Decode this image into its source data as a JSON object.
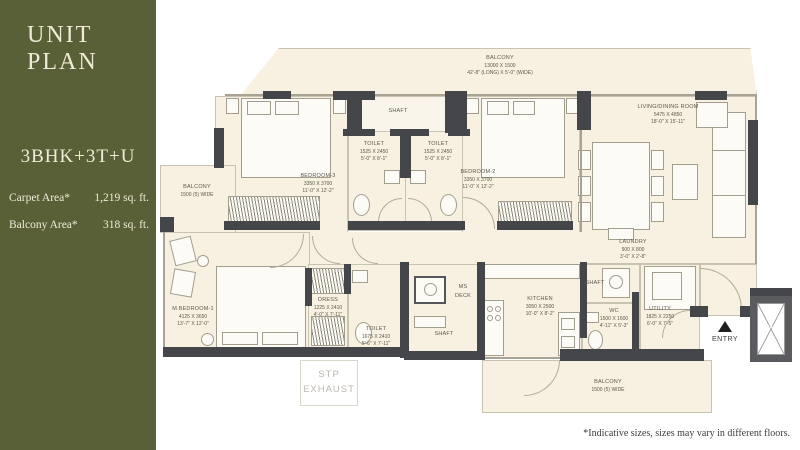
{
  "sidebar": {
    "title": "UNIT PLAN",
    "unit_type": "3BHK+3T+U",
    "stats": [
      {
        "label": "Carpet Area*",
        "value": "1,219 sq. ft."
      },
      {
        "label": "Balcony Area*",
        "value": "318 sq. ft."
      }
    ],
    "bg_color": "#596038",
    "text_color": "#f0ebd7"
  },
  "plan": {
    "rooms": {
      "balcony_top": {
        "name": "BALCONY",
        "mm": "13000 X 1500",
        "ft": "42'-8\" (LONG) X 5'-0\" (WIDE)"
      },
      "shaft_top": {
        "name": "SHAFT"
      },
      "toilet_1": {
        "name": "TOILET",
        "mm": "1525 X 2450",
        "ft": "5'-0\" X 8'-1\""
      },
      "toilet_2": {
        "name": "TOILET",
        "mm": "1525 X 2450",
        "ft": "5'-0\" X 8'-1\""
      },
      "bedroom_3": {
        "name": "BEDROOM-3",
        "mm": "3350 X 3700",
        "ft": "11'-0\" X 12'-2\""
      },
      "bedroom_2": {
        "name": "BEDROOM-2",
        "mm": "3350 X 3700",
        "ft": "11'-0\" X 12'-2\""
      },
      "living": {
        "name": "LIVING/DINING ROOM",
        "mm": "5475 X 4850",
        "ft": "18'-0\" X 15'-11\""
      },
      "balcony_left": {
        "name": "BALCONY",
        "ft": "1500 (5) WIDE"
      },
      "m_bedroom": {
        "name": "M.BEDROOM-1",
        "mm": "4125 X 3650",
        "ft": "13'-7\" X 12'-0\""
      },
      "dress": {
        "name": "DRESS",
        "mm": "1225 X 2410",
        "ft": "4'-0\" X 7'-11\""
      },
      "toilet_m": {
        "name": "TOILET",
        "mm": "1675 X 2410",
        "ft": "5'-6\" X 7'-11\""
      },
      "ms_deck": {
        "line1": "MS",
        "line2": "DECK"
      },
      "shaft_mid": {
        "name": "SHAFT"
      },
      "kitchen": {
        "name": "KITCHEN",
        "mm": "3050 X 2500",
        "ft": "10'-0\" X 8'-2\""
      },
      "laundry": {
        "name": "LAUNDRY",
        "mm": "900 X 800",
        "ft": "3'-0\" X 2'-8\""
      },
      "shaft_laundry": {
        "name": "SHAFT"
      },
      "wc": {
        "name": "WC",
        "mm": "1500 X 1600",
        "ft": "4'-11\" X 5'-3\""
      },
      "utility": {
        "name": "UTILITY",
        "mm": "1825 X 2250",
        "ft": "6'-0\" X 7'-5\""
      },
      "balcony_bottom": {
        "name": "BALCONY",
        "ft": "1500 (5) WIDE"
      },
      "stp": {
        "line1": "STP",
        "line2": "EXHAUST"
      },
      "entry": {
        "name": "ENTRY"
      },
      "shaft_right": {
        "name": "SHAFT"
      }
    },
    "colors": {
      "floor": "#f8f0e0",
      "wall": "#45464a",
      "label": "#5d594d"
    }
  },
  "footnote": "*Indicative sizes, sizes may vary in different floors."
}
